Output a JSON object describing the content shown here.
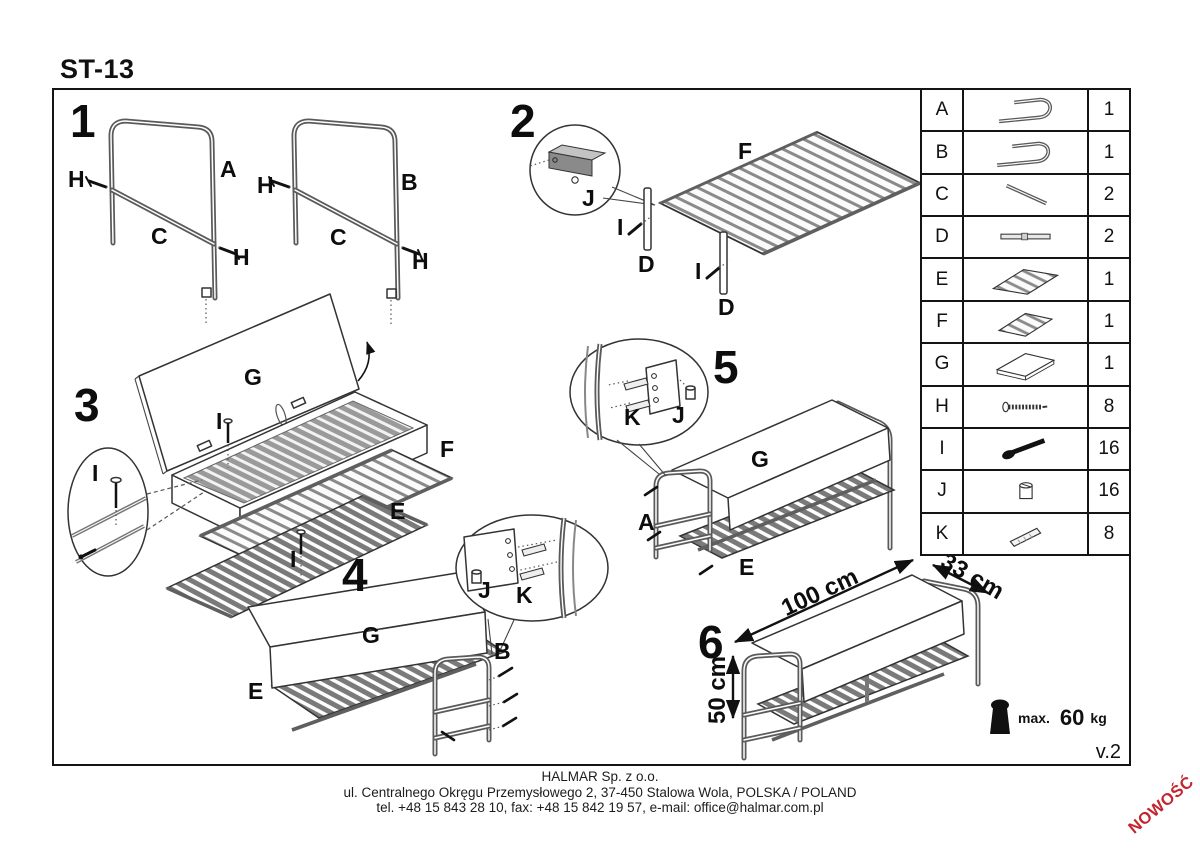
{
  "title": "ST-13",
  "version": "v.2",
  "badge_new": "NOWOŚĆ",
  "steps": [
    {
      "num": "1",
      "labels": {
        "A": "A",
        "B": "B",
        "C": "C",
        "H": "H"
      }
    },
    {
      "num": "2",
      "labels": {
        "F": "F",
        "D": "D",
        "I": "I",
        "J": "J"
      }
    },
    {
      "num": "3",
      "labels": {
        "G": "G",
        "F": "F",
        "E": "E",
        "I": "I"
      }
    },
    {
      "num": "4",
      "labels": {
        "G": "G",
        "E": "E",
        "B": "B",
        "J": "J",
        "K": "K"
      }
    },
    {
      "num": "5",
      "labels": {
        "G": "G",
        "E": "E",
        "A": "A",
        "K": "K",
        "J": "J"
      }
    },
    {
      "num": "6",
      "dims": {
        "length": "100 cm",
        "depth": "33 cm",
        "height": "50 cm"
      }
    }
  ],
  "weight_limit": {
    "prefix": "max.",
    "value": "60",
    "unit": "kg"
  },
  "parts_table": {
    "rows": [
      {
        "part": "A",
        "qty": "1",
        "icon": "side-frame"
      },
      {
        "part": "B",
        "qty": "1",
        "icon": "side-frame"
      },
      {
        "part": "C",
        "qty": "2",
        "icon": "support-bar"
      },
      {
        "part": "D",
        "qty": "2",
        "icon": "flat-bar"
      },
      {
        "part": "E",
        "qty": "1",
        "icon": "slatted-shelf-large"
      },
      {
        "part": "F",
        "qty": "1",
        "icon": "slatted-shelf-small"
      },
      {
        "part": "G",
        "qty": "1",
        "icon": "seat-panel"
      },
      {
        "part": "H",
        "qty": "8",
        "icon": "screw"
      },
      {
        "part": "I",
        "qty": "16",
        "icon": "bolt"
      },
      {
        "part": "J",
        "qty": "16",
        "icon": "barrel-nut"
      },
      {
        "part": "K",
        "qty": "8",
        "icon": "wooden-dowel"
      }
    ]
  },
  "footer": {
    "company": "HALMAR Sp. z o.o.",
    "address": "ul. Centralnego Okręgu Przemysłowego 2, 37-450 Stalowa Wola, POLSKA / POLAND",
    "contact": "tel. +48 15 843 28 10, fax: +48 15 842 19 57, e-mail: office@halmar.com.pl"
  }
}
